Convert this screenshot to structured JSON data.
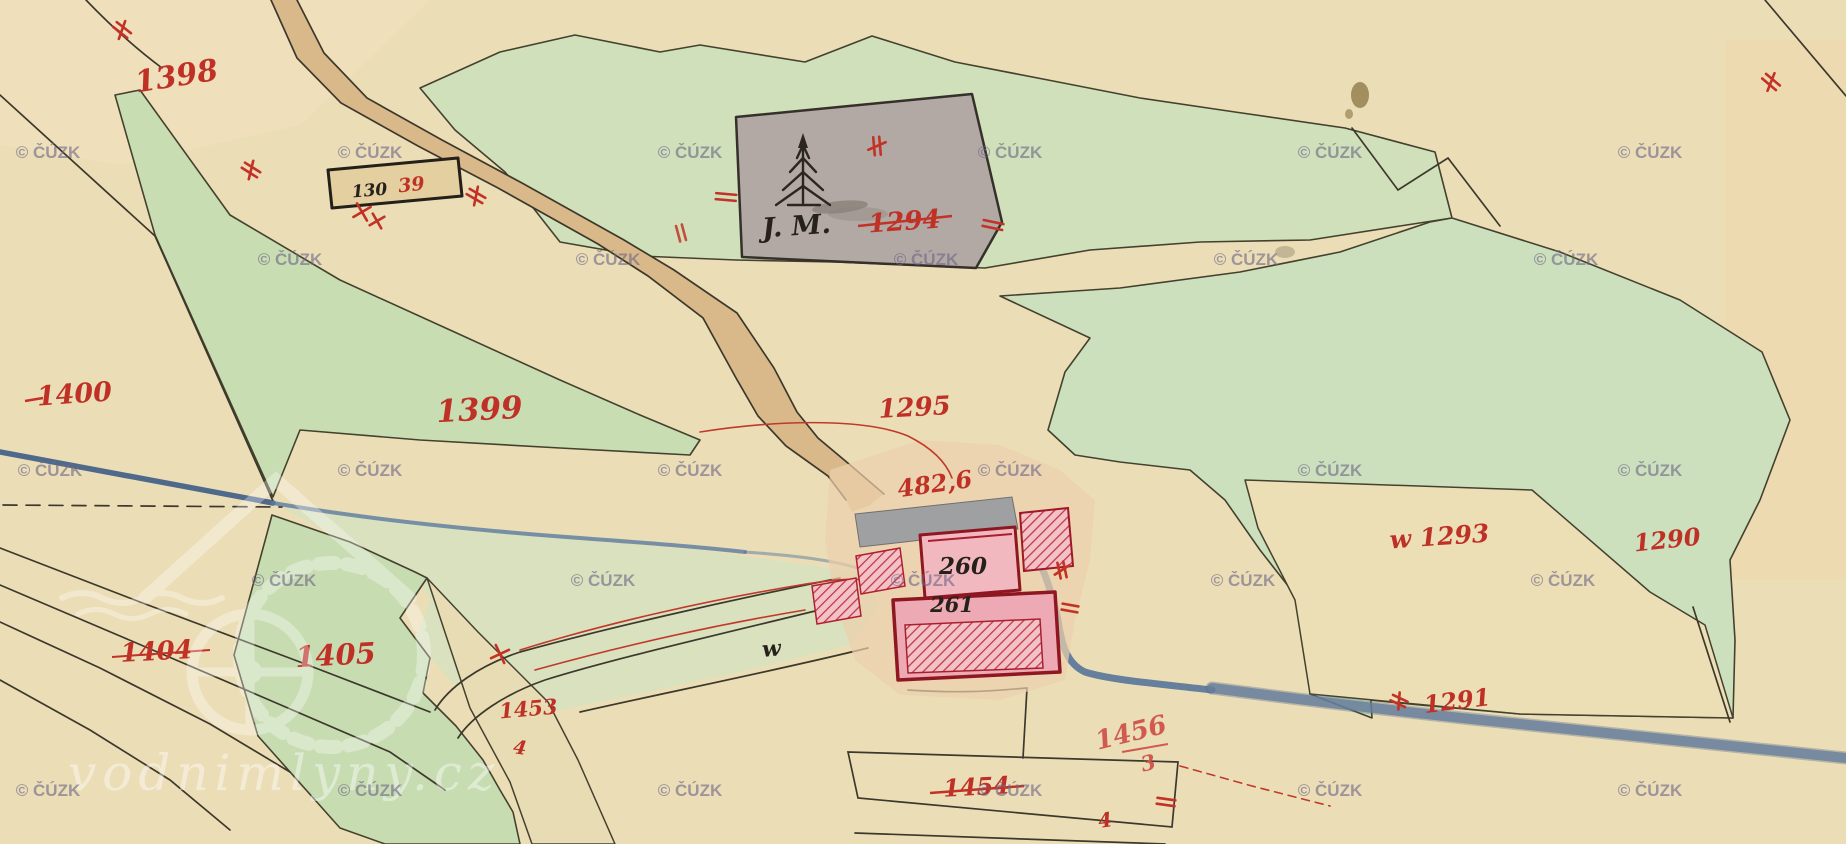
{
  "map": {
    "title": "historical cadastral map sheet (water mill site)",
    "region_labels": {
      "l1398": {
        "text": "1398"
      },
      "l1399": {
        "text": "1399"
      },
      "l1400": {
        "text": "1400"
      },
      "l1294": {
        "text": "1294"
      },
      "l1295": {
        "text": "1295"
      },
      "l482_6": {
        "text": "482,6"
      },
      "lw1293": {
        "text": "w 1293"
      },
      "l1290": {
        "text": "1290"
      },
      "l1404": {
        "text": "1404"
      },
      "l1405": {
        "text": "1405"
      },
      "l1453": {
        "text": "1453"
      },
      "l1291": {
        "text": "1291"
      },
      "l1456": {
        "text": "1456"
      },
      "l1456_sub": {
        "text": "3"
      },
      "l1454": {
        "text": "1454"
      },
      "l39": {
        "text": "39"
      },
      "l4a": {
        "text": "4"
      },
      "l4b": {
        "text": "4"
      }
    },
    "building_labels": {
      "house_box": {
        "text": "130"
      },
      "jm": {
        "text": "J. M."
      },
      "b260": {
        "text": "260"
      },
      "b261": {
        "text": "261"
      },
      "w_script": {
        "text": "w"
      }
    },
    "watermarks": {
      "cuzk": "© ČÚZK",
      "site": "vodnimlyny.cz"
    },
    "colors": {
      "paper": "#ebdeb7",
      "meadow_green": "#cfe0ba",
      "road_tan": "#d9b98a",
      "parcel_gray": "#b2a8a4",
      "building_pink": "#f0b4bd",
      "building_outline": "#8e1722",
      "label_red": "#bf3127",
      "stream_blue": "#5a7aa0",
      "watermark_purple": "#6f6888"
    }
  }
}
